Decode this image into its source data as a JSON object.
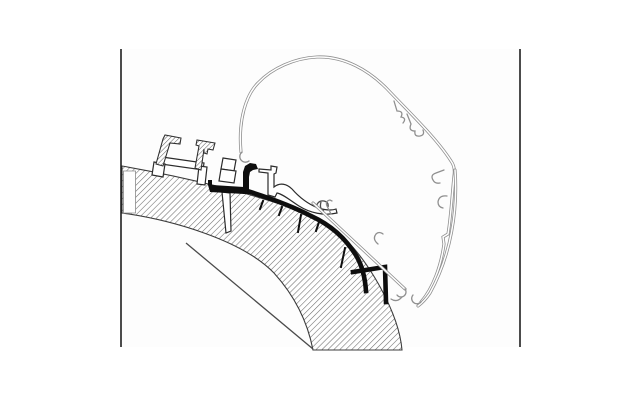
{
  "figure": {
    "kind": "technical-cross-section-diagram",
    "subject": "awning-roof-adapter-profile-on-caravan-roof",
    "text_labels": []
  },
  "canvas": {
    "width": 640,
    "height": 400,
    "background": "#ffffff",
    "inner_panel": "#fdfdfd"
  },
  "colors": {
    "frame_line": "#1f1f1f",
    "heavy_profile": "#0e0e0e",
    "outline_gray": "#8f8f8f",
    "hatch_line": "#6b6b6b",
    "background": "#ffffff"
  },
  "paths": {
    "panel": "M121,49 L520,49 L520,347 L121,347 Z",
    "frame_left": "M121,49 L121,347",
    "frame_right": "M520,49 L520,347",
    "roof_band": "M122,166 C185,177 255,194 303,212 C340,228 358,250 375,278 C388,300 400,326 402,350 L313,350 C307,319 293,294 274,273 C242,240 172,220 122,213 Z",
    "band_notch": "M123.5,171 L135.5,171 L135.5,213 L123.5,213 Z",
    "inner_skin_line": "M186,243 L313,349",
    "rail_left": "M156,164 L163,139 L165,135 L181,138 L180,144 L170,143 L163,166 Z",
    "rail_right": "M195,168 L199,146 L196,145 L197,140 L215,143 L213,150 L208,149 L207,154 L204,153 L204,149 L201,170 Z",
    "rail_bridge": "M162,157 L204,163 L203,170 L161,164 Z",
    "rail_post_right": "M199,166 L207,167 L205,185 L197,184 Z",
    "rail_foot_left": "M154,162 L165,164 L163,177 L152,175 Z",
    "screw_head_top": "M223,158 L236,160 L234,171 L221,169 Z",
    "screw_head_base": "M221,169 L236,171 L234,183 L219,181 Z",
    "screw_shaft": "M222,192 L230,193 L231,231 L226,233 Z",
    "adapter_clamp": "M208,185 L208,180 L212,180 L212,185 L244,187 L244,194 L210,192 Z",
    "adapter_riser": "M243,194 L243,172 L245,166 L250,163 L256,164 L258,169 L253,170 L250,172 L249,177 L249,194 Z",
    "adapter_spine": "M244,190 C270,198 294,207 311,216 C333,226 347,240 357,257 C362,266 365,277 366,291",
    "adapter_hook": "M353,272 L385,267 L386,302",
    "adapter_teeth": "M263,201 L260,209 M282,207 L279,215 M301,215 L298,232 M319,222 L316,231 M345,248 L341,267",
    "swoosh_profile": "M259,169 L271,170 L271,166 L277,167 L276,173 L274,174 L274,187 C280,182 287,184 292,189 C299,197 308,204 318,208 C325,210 331,211 336,209 L337,213 C324,216 310,213 299,206 C291,201 283,194 277,193 L275,197 L268,195 L268,173 L259,172 Z",
    "anchor_detail": "M316,207 Q318,200 324,201 Q329,202 328,207 M321,202 Q319,209 324,211",
    "case_lip_curl": "M249,161 a5,5 0 1 1 -7,-9",
    "case_outline": "M241,152 C238,120 246,95 258,83 C272,68 295,58 317,57 C343,56 369,69 391,93 C412,115 437,139 451,161 C454,165 455,170 454,176 C452,196 451,216 448,234 L443,237 L444,244 C441,266 433,288 421,302",
    "case_wall_curl": "M421,302 a5,5 0 1 1 -8,-7",
    "case_arc": "M455,170 C458,210 451,255 430,293 C426,299 422,303 418,306",
    "case_clip_1": "M394,101 l3,10 q7,0 4,6 q6,1 2,6",
    "case_clip_2": "M407,114 l4,10 q-3,7 4,7 q-1,6 5,5 q5,-1 3,-6",
    "case_clip_3": "M444,170 l-8,3 q-6,2 -3,7 q2,4 7,3",
    "case_clip_4": "M447,196 q-8,-1 -9,6 q0,5 5,6",
    "bottom_rail": "M313,203 L405,289",
    "bottom_rail_curl": "M405,289 a5,5 0 1 1 -8,6",
    "bottom_rail_hook_1": "M331,214 l-4,-8 q-2,-5 3,-6 l2,1",
    "bottom_rail_hook_2": "M378,244 q-6,-5 -2,-10 q3,-3 7,0",
    "bottom_rail_end_clip": "M402,297 q-5,6 -11,2"
  }
}
